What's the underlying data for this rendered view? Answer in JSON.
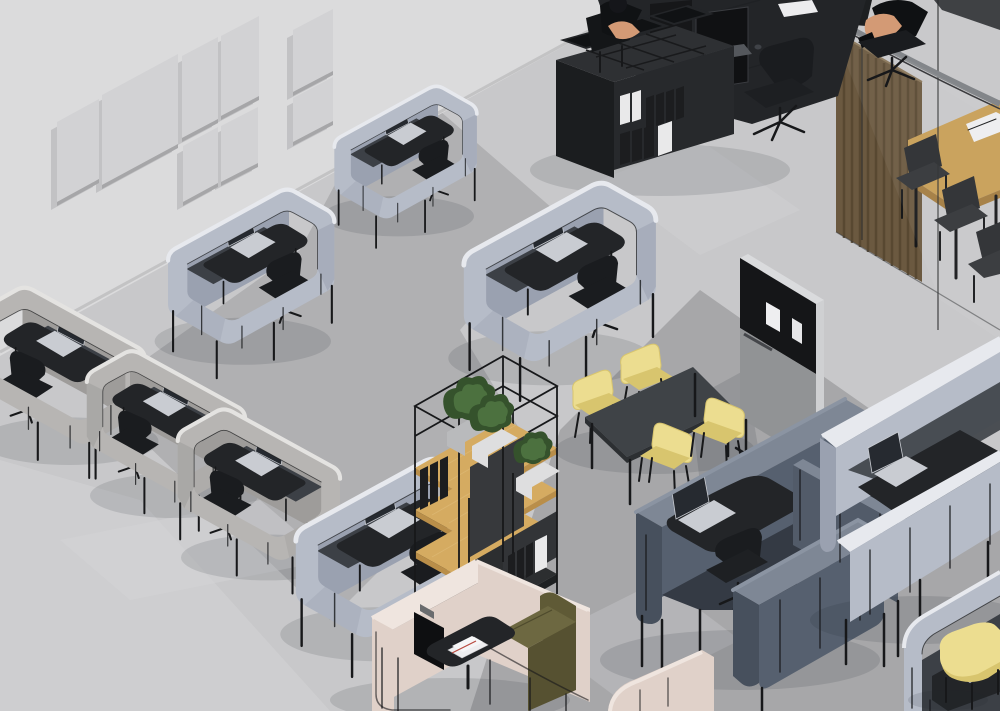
{
  "scene": {
    "setting": "Isometric 3D render of a modern open-plan office interior with acoustic furniture",
    "objects": [
      {
        "name": "acoustic-wall-panels",
        "count": 8,
        "wall": "upper-left concrete wall"
      },
      {
        "name": "focus-work-pod-light-gray",
        "count": 6,
        "contents": [
          "black desk",
          "silver laptop",
          "black office chair"
        ]
      },
      {
        "name": "focus-work-pod-warm-gray",
        "count": 3,
        "contents": [
          "black desk",
          "monitor",
          "black office chair"
        ]
      },
      {
        "name": "team-workstation",
        "desk": "black double desk",
        "monitors": 2,
        "storage": "black shelving with binders",
        "people": 2,
        "chairs": 2
      },
      {
        "name": "glass-partition",
        "feature": "curved rail with wood-slat screen"
      },
      {
        "name": "meeting-table-wood",
        "chairs_black": 3,
        "papers": true
      },
      {
        "name": "open-shelving-unit",
        "frame": "black steel",
        "shelves": "oak",
        "plants": 3,
        "binders": true
      },
      {
        "name": "mobile-pin-board",
        "pinned_notes": 2
      },
      {
        "name": "workshop-table-black",
        "yellow_chairs": 4
      },
      {
        "name": "acoustic-pod-navy",
        "count": 1,
        "contents": [
          "black desk",
          "silver laptop",
          "black office chairs"
        ]
      },
      {
        "name": "lounge-pod-pink",
        "sofa": "olive green",
        "tv": true,
        "coffee-table": "black with magazines"
      },
      {
        "name": "pouf-yellow",
        "count": 2
      }
    ]
  },
  "colors": {
    "wall": "#dbdbdc",
    "wallPanel": "#d2d2d4",
    "wallPanelEdge": "#a6a6a8",
    "floor": "#c8c8ca",
    "floorMatA": "#aeaeb0",
    "floorMatB": "#a7a7a9",
    "floorLight": "#d4d4d6",
    "floorGlass": "#c9c9cb",
    "podBlue": "#b6bcc8",
    "podBlueShade": "#9aa1b0",
    "podWarm": "#b7b5b3",
    "podWarmShade": "#9e9c9a",
    "podNavy": "#56606f",
    "podNavyShade": "#47505d",
    "podNavyRim": "#7e8795",
    "podPink": "#e0d1c9",
    "podPinkShade": "#c8b7af",
    "podPinkRim": "#efe5df",
    "podRim": "#e7e9ee",
    "interiorDark": "#3c4046",
    "deskBlack": "#232528",
    "chairBlack": "#1a1c1f",
    "metalBlack": "#17181a",
    "laptopSilver": "#c9ccd2",
    "laptopScreen": "#262a30",
    "monitorBlack": "#141517",
    "keyboardGray": "#54575c",
    "yellow": "#ecdd90",
    "yellowShade": "#d8c56e",
    "olive": "#6d6841",
    "oliveShade": "#565131",
    "wood": "#d5ab61",
    "woodEdge": "#b98e49",
    "woodSlat": "#6b5940",
    "woodSlatDark": "#55462f",
    "meetingWood": "#c89f56",
    "plantGreen": "#4c713f",
    "plantDark": "#35522c",
    "planterWhite": "#dededf",
    "planterGray": "#b9babc",
    "binderBlack": "#1c1d1f",
    "binderWhite": "#e9e9ea",
    "paperWhite": "#eeeef0",
    "skin": "#d39a75",
    "glassFrame": "#2c2d2f",
    "glassRail": "#83868a",
    "shadow": "#22252b"
  }
}
